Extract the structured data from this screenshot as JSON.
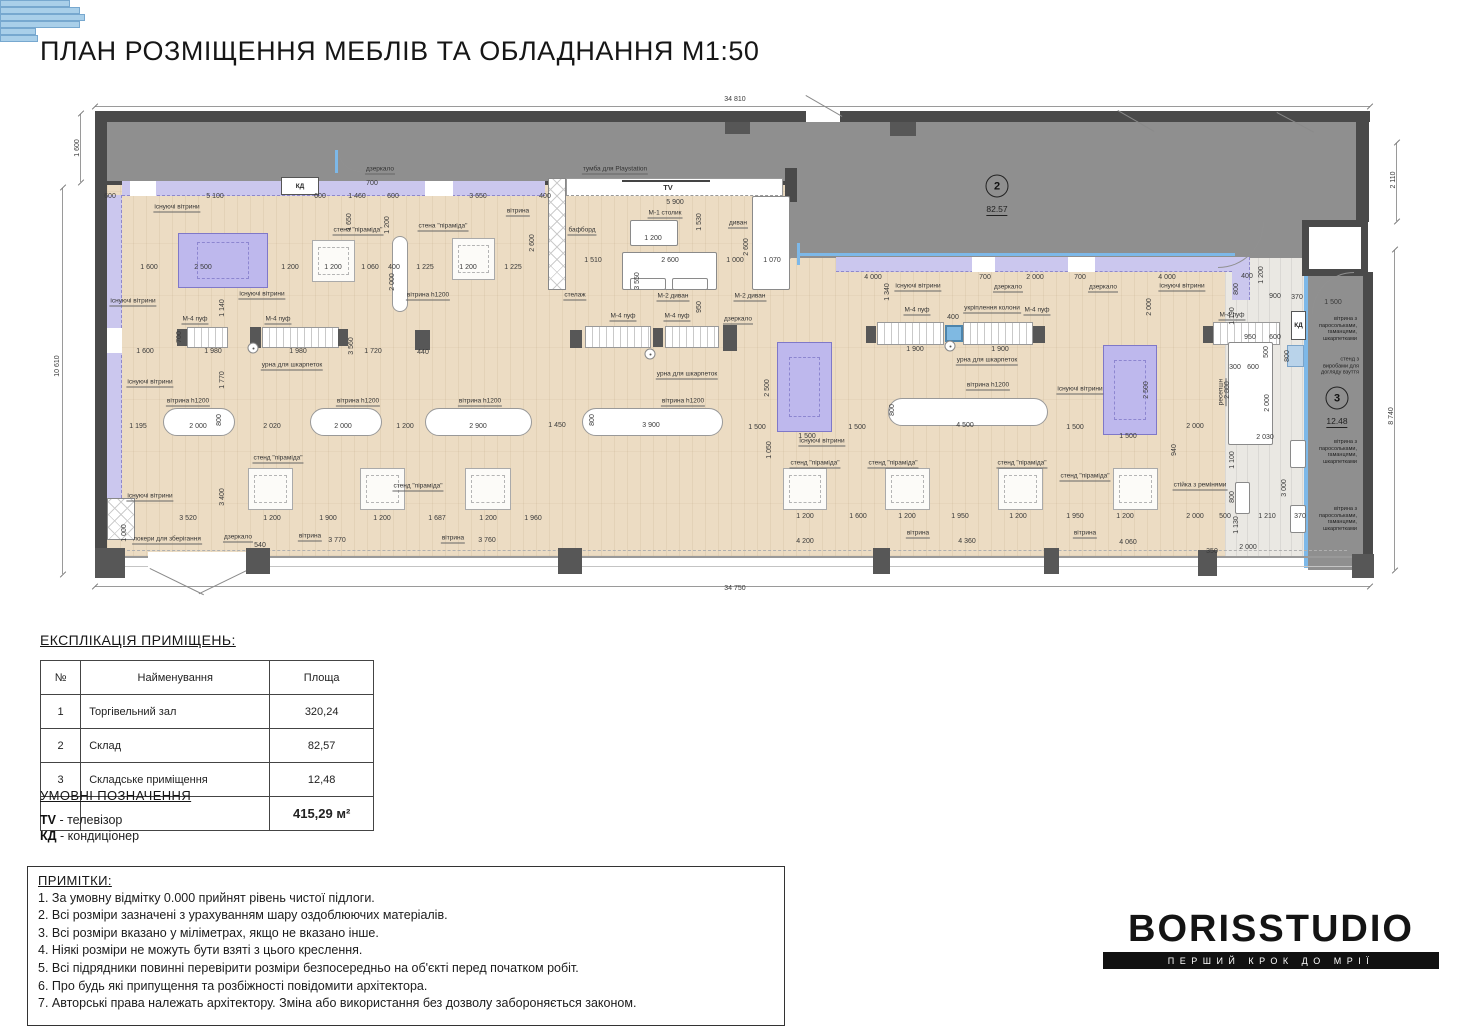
{
  "title": "ПЛАН РОЗМІЩЕННЯ МЕБЛІВ ТА ОБЛАДНАННЯ М1:50",
  "colors": {
    "floor": "#ecdcc3",
    "wall": "#4a4a4a",
    "storage_fill": "#8f8f8f",
    "vitrine_strip": "#cbc7ee",
    "glazing_blue": "#7db8e8",
    "existing_vitrine": "#beb8ed"
  },
  "plan": {
    "kd": "КД",
    "rooms": [
      {
        "n": "2",
        "a": "82.57",
        "x": 997,
        "y": 186
      },
      {
        "n": "3",
        "a": "12.48",
        "x": 1337,
        "y": 398
      }
    ],
    "dims": [
      [
        "34 810",
        735,
        100
      ],
      [
        "34 750",
        735,
        589
      ],
      [
        "1 600",
        78,
        148,
        1
      ],
      [
        "10 610",
        58,
        366,
        1
      ],
      [
        "2 110",
        1394,
        180,
        1
      ],
      [
        "8 740",
        1392,
        416,
        1
      ],
      [
        "600",
        110,
        197
      ],
      [
        "5 100",
        215,
        197
      ],
      [
        "600",
        320,
        197
      ],
      [
        "700",
        372,
        184
      ],
      [
        "1 460",
        357,
        197
      ],
      [
        "600",
        393,
        197
      ],
      [
        "3 650",
        478,
        197
      ],
      [
        "400",
        545,
        197
      ],
      [
        "5 900",
        675,
        203
      ],
      [
        "1 650",
        350,
        222,
        1
      ],
      [
        "1 200",
        388,
        225,
        1
      ],
      [
        "2 600",
        533,
        243,
        1
      ],
      [
        "2 000",
        393,
        282,
        1
      ],
      [
        "1 530",
        700,
        222,
        1
      ],
      [
        "2 600",
        747,
        247,
        1
      ],
      [
        "1 600",
        149,
        268
      ],
      [
        "2 500",
        203,
        268
      ],
      [
        "1 200",
        290,
        268
      ],
      [
        "1 200",
        333,
        268
      ],
      [
        "1 060",
        370,
        268
      ],
      [
        "400",
        394,
        268
      ],
      [
        "1 225",
        425,
        268
      ],
      [
        "1 200",
        468,
        268
      ],
      [
        "1 225",
        513,
        268
      ],
      [
        "1 510",
        593,
        261
      ],
      [
        "2 600",
        670,
        261
      ],
      [
        "1 000",
        735,
        261
      ],
      [
        "1 070",
        772,
        261
      ],
      [
        "1 200",
        653,
        239
      ],
      [
        "1 140",
        223,
        308,
        1
      ],
      [
        "1 770",
        223,
        380,
        1
      ],
      [
        "3 550",
        638,
        281,
        1
      ],
      [
        "950",
        700,
        307,
        1
      ],
      [
        "4 000",
        873,
        278
      ],
      [
        "700",
        985,
        278
      ],
      [
        "2 000",
        1035,
        278
      ],
      [
        "700",
        1080,
        278
      ],
      [
        "4 000",
        1167,
        278
      ],
      [
        "400",
        1247,
        277
      ],
      [
        "800",
        1237,
        289,
        1
      ],
      [
        "1 200",
        1262,
        275,
        1
      ],
      [
        "900",
        1275,
        297
      ],
      [
        "370",
        1297,
        298
      ],
      [
        "1 500",
        1333,
        303
      ],
      [
        "1 190",
        1233,
        316,
        1
      ],
      [
        "2 000",
        1150,
        307,
        1
      ],
      [
        "1 340",
        888,
        292,
        1
      ],
      [
        "1 600",
        145,
        352
      ],
      [
        "1 980",
        213,
        352
      ],
      [
        "1 980",
        298,
        352
      ],
      [
        "3 560",
        352,
        346,
        1
      ],
      [
        "1 720",
        373,
        352
      ],
      [
        "440",
        423,
        353
      ],
      [
        "1 900",
        915,
        350
      ],
      [
        "1 900",
        1000,
        350
      ],
      [
        "700",
        180,
        337,
        1
      ],
      [
        "400",
        953,
        318
      ],
      [
        "1 195",
        138,
        427
      ],
      [
        "2 000",
        198,
        427
      ],
      [
        "800",
        220,
        420,
        1
      ],
      [
        "2 020",
        272,
        427
      ],
      [
        "2 000",
        343,
        427
      ],
      [
        "1 200",
        405,
        427
      ],
      [
        "2 900",
        478,
        427
      ],
      [
        "1 450",
        557,
        426
      ],
      [
        "800",
        593,
        420,
        1
      ],
      [
        "3 900",
        651,
        426
      ],
      [
        "1 500",
        757,
        428
      ],
      [
        "1 500",
        807,
        437
      ],
      [
        "2 500",
        768,
        388,
        1
      ],
      [
        "1 500",
        857,
        428
      ],
      [
        "4 500",
        965,
        426
      ],
      [
        "800",
        893,
        410,
        1
      ],
      [
        "1 500",
        1075,
        428
      ],
      [
        "1 500",
        1128,
        437
      ],
      [
        "2 500",
        1147,
        390,
        1
      ],
      [
        "2 000",
        1195,
        427
      ],
      [
        "1 050",
        770,
        450,
        1
      ],
      [
        "940",
        1175,
        450,
        1
      ],
      [
        "950",
        1250,
        338
      ],
      [
        "600",
        1275,
        338
      ],
      [
        "500",
        1267,
        352,
        1
      ],
      [
        "800",
        1288,
        356,
        1
      ],
      [
        "300",
        1235,
        368
      ],
      [
        "600",
        1253,
        368
      ],
      [
        "2 800",
        1228,
        390,
        1
      ],
      [
        "2 000",
        1268,
        403,
        1
      ],
      [
        "2 030",
        1265,
        438
      ],
      [
        "1 100",
        1233,
        460,
        1
      ],
      [
        "800",
        1233,
        497,
        1
      ],
      [
        "1 130",
        1237,
        525,
        1
      ],
      [
        "3 000",
        1285,
        488,
        1
      ],
      [
        "500",
        1225,
        517
      ],
      [
        "1 210",
        1267,
        517
      ],
      [
        "370",
        1300,
        517
      ],
      [
        "3 520",
        188,
        519
      ],
      [
        "1 200",
        272,
        519
      ],
      [
        "1 900",
        328,
        519
      ],
      [
        "1 200",
        382,
        519
      ],
      [
        "1 687",
        437,
        519
      ],
      [
        "1 200",
        488,
        519
      ],
      [
        "1 960",
        533,
        519
      ],
      [
        "3 400",
        223,
        497,
        1
      ],
      [
        "1 000",
        125,
        533,
        1
      ],
      [
        "1 200",
        805,
        517
      ],
      [
        "1 600",
        858,
        517
      ],
      [
        "1 200",
        907,
        517
      ],
      [
        "1 950",
        960,
        517
      ],
      [
        "1 200",
        1018,
        517
      ],
      [
        "1 950",
        1075,
        517
      ],
      [
        "1 200",
        1125,
        517
      ],
      [
        "2 000",
        1195,
        517
      ],
      [
        "540",
        260,
        546
      ],
      [
        "3 770",
        337,
        541
      ],
      [
        "3 760",
        487,
        541
      ],
      [
        "4 200",
        805,
        542
      ],
      [
        "4 360",
        967,
        542
      ],
      [
        "4 060",
        1128,
        543
      ],
      [
        "350",
        1212,
        552
      ],
      [
        "2 000",
        1248,
        548
      ]
    ],
    "labels": [
      [
        "існуючі вітрини",
        177,
        208,
        0
      ],
      [
        "існуючі вітрини",
        133,
        302,
        0
      ],
      [
        "існуючі вітрини",
        150,
        383,
        0
      ],
      [
        "існуючі вітрини",
        150,
        497,
        0
      ],
      [
        "існуючі вітрини",
        262,
        295,
        0
      ],
      [
        "існуючі вітрини",
        918,
        287,
        0
      ],
      [
        "існуючі вітрини",
        1182,
        287,
        0
      ],
      [
        "існуючі вітрини",
        822,
        442,
        0
      ],
      [
        "існуючі вітрини",
        1080,
        390,
        0
      ],
      [
        "дзеркало",
        380,
        170,
        0
      ],
      [
        "дзеркало",
        738,
        320,
        0
      ],
      [
        "дзеркало",
        1008,
        288,
        0
      ],
      [
        "дзеркало",
        1103,
        288,
        0
      ],
      [
        "дзеркало",
        238,
        538,
        0
      ],
      [
        "М-4 пуф",
        195,
        320,
        0
      ],
      [
        "М-4 пуф",
        278,
        320,
        0
      ],
      [
        "М-4 пуф",
        623,
        317,
        0
      ],
      [
        "М-4 пуф",
        677,
        317,
        0
      ],
      [
        "М-4 пуф",
        917,
        311,
        0
      ],
      [
        "М-4 пуф",
        1037,
        311,
        0
      ],
      [
        "М-4 пуф",
        1232,
        316,
        0
      ],
      [
        "урна для шкарпеток",
        292,
        366,
        0
      ],
      [
        "урна для шкарпеток",
        687,
        375,
        0
      ],
      [
        "урна для шкарпеток",
        987,
        361,
        0
      ],
      [
        "вітрина h1200",
        188,
        402,
        0
      ],
      [
        "вітрина h1200",
        358,
        402,
        0
      ],
      [
        "вітрина h1200",
        480,
        402,
        0
      ],
      [
        "вітрина h1200",
        683,
        402,
        0
      ],
      [
        "вітрина h1200",
        988,
        386,
        0
      ],
      [
        "вітрина h1200",
        428,
        296,
        0
      ],
      [
        "стена \"піраміда\"",
        358,
        231,
        0
      ],
      [
        "стена \"піраміда\"",
        443,
        227,
        0
      ],
      [
        "стенд \"піраміда\"",
        278,
        459,
        0
      ],
      [
        "стенд \"піраміда\"",
        418,
        487,
        0
      ],
      [
        "стенд \"піраміда\"",
        815,
        464,
        0
      ],
      [
        "стенд \"піраміда\"",
        893,
        464,
        0
      ],
      [
        "стенд \"піраміда\"",
        1022,
        464,
        0
      ],
      [
        "стенд \"піраміда\"",
        1085,
        477,
        0
      ],
      [
        "тумба для Playstation",
        615,
        170,
        0
      ],
      [
        "TV",
        668,
        188,
        3
      ],
      [
        "М-1 столик",
        665,
        214,
        0
      ],
      [
        "диван",
        738,
        224,
        0
      ],
      [
        "М-2 диван",
        673,
        297,
        0
      ],
      [
        "М-2 диван",
        750,
        297,
        0
      ],
      [
        "стелаж",
        575,
        296,
        0
      ],
      [
        "бафборд",
        582,
        231,
        0
      ],
      [
        "укріплення колони",
        992,
        309,
        0
      ],
      [
        "ресепшн",
        1222,
        392,
        1
      ],
      [
        "стійка з ремінями",
        1200,
        486,
        0
      ],
      [
        "локери для зберігання",
        167,
        540,
        0
      ],
      [
        "вітрина",
        518,
        212,
        0
      ],
      [
        "вітрина",
        310,
        537,
        0
      ],
      [
        "вітрина",
        453,
        539,
        0
      ],
      [
        "вітрина",
        918,
        534,
        0
      ],
      [
        "вітрина",
        1085,
        534,
        0
      ],
      [
        "вітрина з\nпаросольками,\nгаманцями,\nшкарпетками",
        1338,
        329,
        2
      ],
      [
        "стенд з\nвиробами для\nдогляду взуття",
        1340,
        366,
        2
      ],
      [
        "вітрина з\nпаросольками,\nгаманцями,\nшкарпетками",
        1338,
        452,
        2
      ],
      [
        "вітрина з\nпаросольками,\nгаманцями,\nшкарпетками",
        1338,
        519,
        2
      ]
    ],
    "furniture": {
      "purples": [
        [
          178,
          233,
          90,
          55
        ],
        [
          777,
          342,
          55,
          90
        ],
        [
          1103,
          345,
          54,
          90
        ]
      ],
      "ovalsH": [
        [
          163,
          408,
          72,
          28
        ],
        [
          310,
          408,
          72,
          28
        ],
        [
          425,
          408,
          107,
          28
        ],
        [
          582,
          408,
          141,
          28
        ],
        [
          888,
          398,
          160,
          28
        ]
      ],
      "ovalsV": [
        [
          392,
          236,
          16,
          76
        ]
      ],
      "pyramids": [
        [
          312,
          240,
          43,
          42
        ],
        [
          452,
          238,
          43,
          42
        ],
        [
          248,
          468,
          45,
          42
        ],
        [
          360,
          468,
          45,
          42
        ],
        [
          465,
          468,
          46,
          42
        ],
        [
          783,
          468,
          44,
          42
        ],
        [
          885,
          468,
          45,
          42
        ],
        [
          998,
          468,
          45,
          42
        ],
        [
          1113,
          468,
          45,
          42
        ]
      ],
      "benches": [
        [
          187,
          327,
          41,
          21
        ],
        [
          262,
          327,
          77,
          21
        ],
        [
          585,
          326,
          66,
          22
        ],
        [
          665,
          326,
          54,
          22
        ],
        [
          877,
          322,
          67,
          23
        ],
        [
          963,
          322,
          70,
          23
        ],
        [
          1213,
          322,
          67,
          23
        ]
      ],
      "darks": [
        [
          177,
          329,
          10,
          17
        ],
        [
          250,
          327,
          11,
          21
        ],
        [
          338,
          329,
          10,
          17
        ],
        [
          570,
          330,
          12,
          18
        ],
        [
          653,
          328,
          10,
          19
        ],
        [
          723,
          325,
          14,
          26
        ],
        [
          866,
          326,
          10,
          17
        ],
        [
          1033,
          326,
          12,
          17
        ],
        [
          1203,
          326,
          10,
          17
        ],
        [
          415,
          330,
          15,
          20
        ],
        [
          1245,
          376,
          14,
          13
        ],
        [
          1245,
          408,
          14,
          13
        ]
      ],
      "columns": [
        [
          945,
          325,
          18,
          17
        ]
      ],
      "shelves": [
        [
          548,
          178,
          18,
          112
        ],
        [
          107,
          498,
          28,
          42
        ]
      ],
      "whites": [
        [
          622,
          252,
          95,
          38
        ],
        [
          630,
          278,
          36,
          12
        ],
        [
          672,
          278,
          36,
          12
        ],
        [
          752,
          196,
          38,
          94
        ],
        [
          630,
          220,
          48,
          26
        ],
        [
          1228,
          342,
          45,
          103
        ],
        [
          1235,
          482,
          15,
          32
        ],
        [
          1290,
          440,
          16,
          28
        ],
        [
          1290,
          505,
          16,
          28
        ]
      ],
      "blues": [
        [
          1287,
          345,
          17,
          22
        ]
      ],
      "urns": [
        [
          253,
          348
        ],
        [
          650,
          354
        ],
        [
          950,
          346
        ]
      ],
      "piers": [
        [
          95,
          548,
          30,
          30
        ],
        [
          246,
          548,
          24,
          26
        ],
        [
          558,
          548,
          24,
          26
        ],
        [
          873,
          548,
          17,
          26
        ],
        [
          1044,
          548,
          15,
          26
        ],
        [
          1198,
          550,
          19,
          26
        ],
        [
          1352,
          554,
          22,
          24
        ],
        [
          725,
          122,
          25,
          12
        ],
        [
          890,
          122,
          26,
          14
        ]
      ],
      "glazing": [
        [
          520,
          559,
          70,
          7
        ],
        [
          655,
          559,
          80,
          7
        ],
        [
          790,
          559,
          85,
          7
        ],
        [
          935,
          559,
          80,
          7
        ],
        [
          1117,
          560,
          36,
          7
        ],
        [
          1245,
          562,
          38,
          7
        ]
      ]
    }
  },
  "explication": {
    "heading": "ЕКСПЛІКАЦІЯ ПРИМІЩЕНЬ:",
    "columns": [
      "№",
      "Найменування",
      "Площа"
    ],
    "rows": [
      [
        "1",
        "Торгівельний зал",
        "320,24"
      ],
      [
        "2",
        "Склад",
        "82,57"
      ],
      [
        "3",
        "Складське приміщення",
        "12,48"
      ]
    ],
    "total": "415,29 м²"
  },
  "legend": {
    "heading": "УМОВНІ ПОЗНАЧЕННЯ",
    "items": [
      {
        "abbr": "TV",
        "desc": "телевізор"
      },
      {
        "abbr": "КД",
        "desc": "кондиціонер"
      }
    ]
  },
  "notes": {
    "heading": "ПРИМІТКИ:",
    "items": [
      "1. За умовну відмітку 0.000 прийнят рівень чистої підлоги.",
      "2. Всі розміри зазначені з урахуванням шару оздоблюючих матеріалів.",
      "3. Всі розміри вказано у міліметрах, якщо не вказано інше.",
      "4. Ніякі розміри не можуть бути взяті з цього креслення.",
      "5. Всі підрядники повинні перевірити розміри безпосередньо на об'єкті перед початком робіт.",
      "6. Про будь які припущення та розбіжності повідомити архітектора.",
      "7. Авторські права належать архітектору. Зміна або використання без дозволу забороняється законом."
    ]
  },
  "logo": {
    "name": "BORISSTUDIO",
    "tagline": "ПЕРШИЙ КРОК ДО МРІЇ"
  }
}
